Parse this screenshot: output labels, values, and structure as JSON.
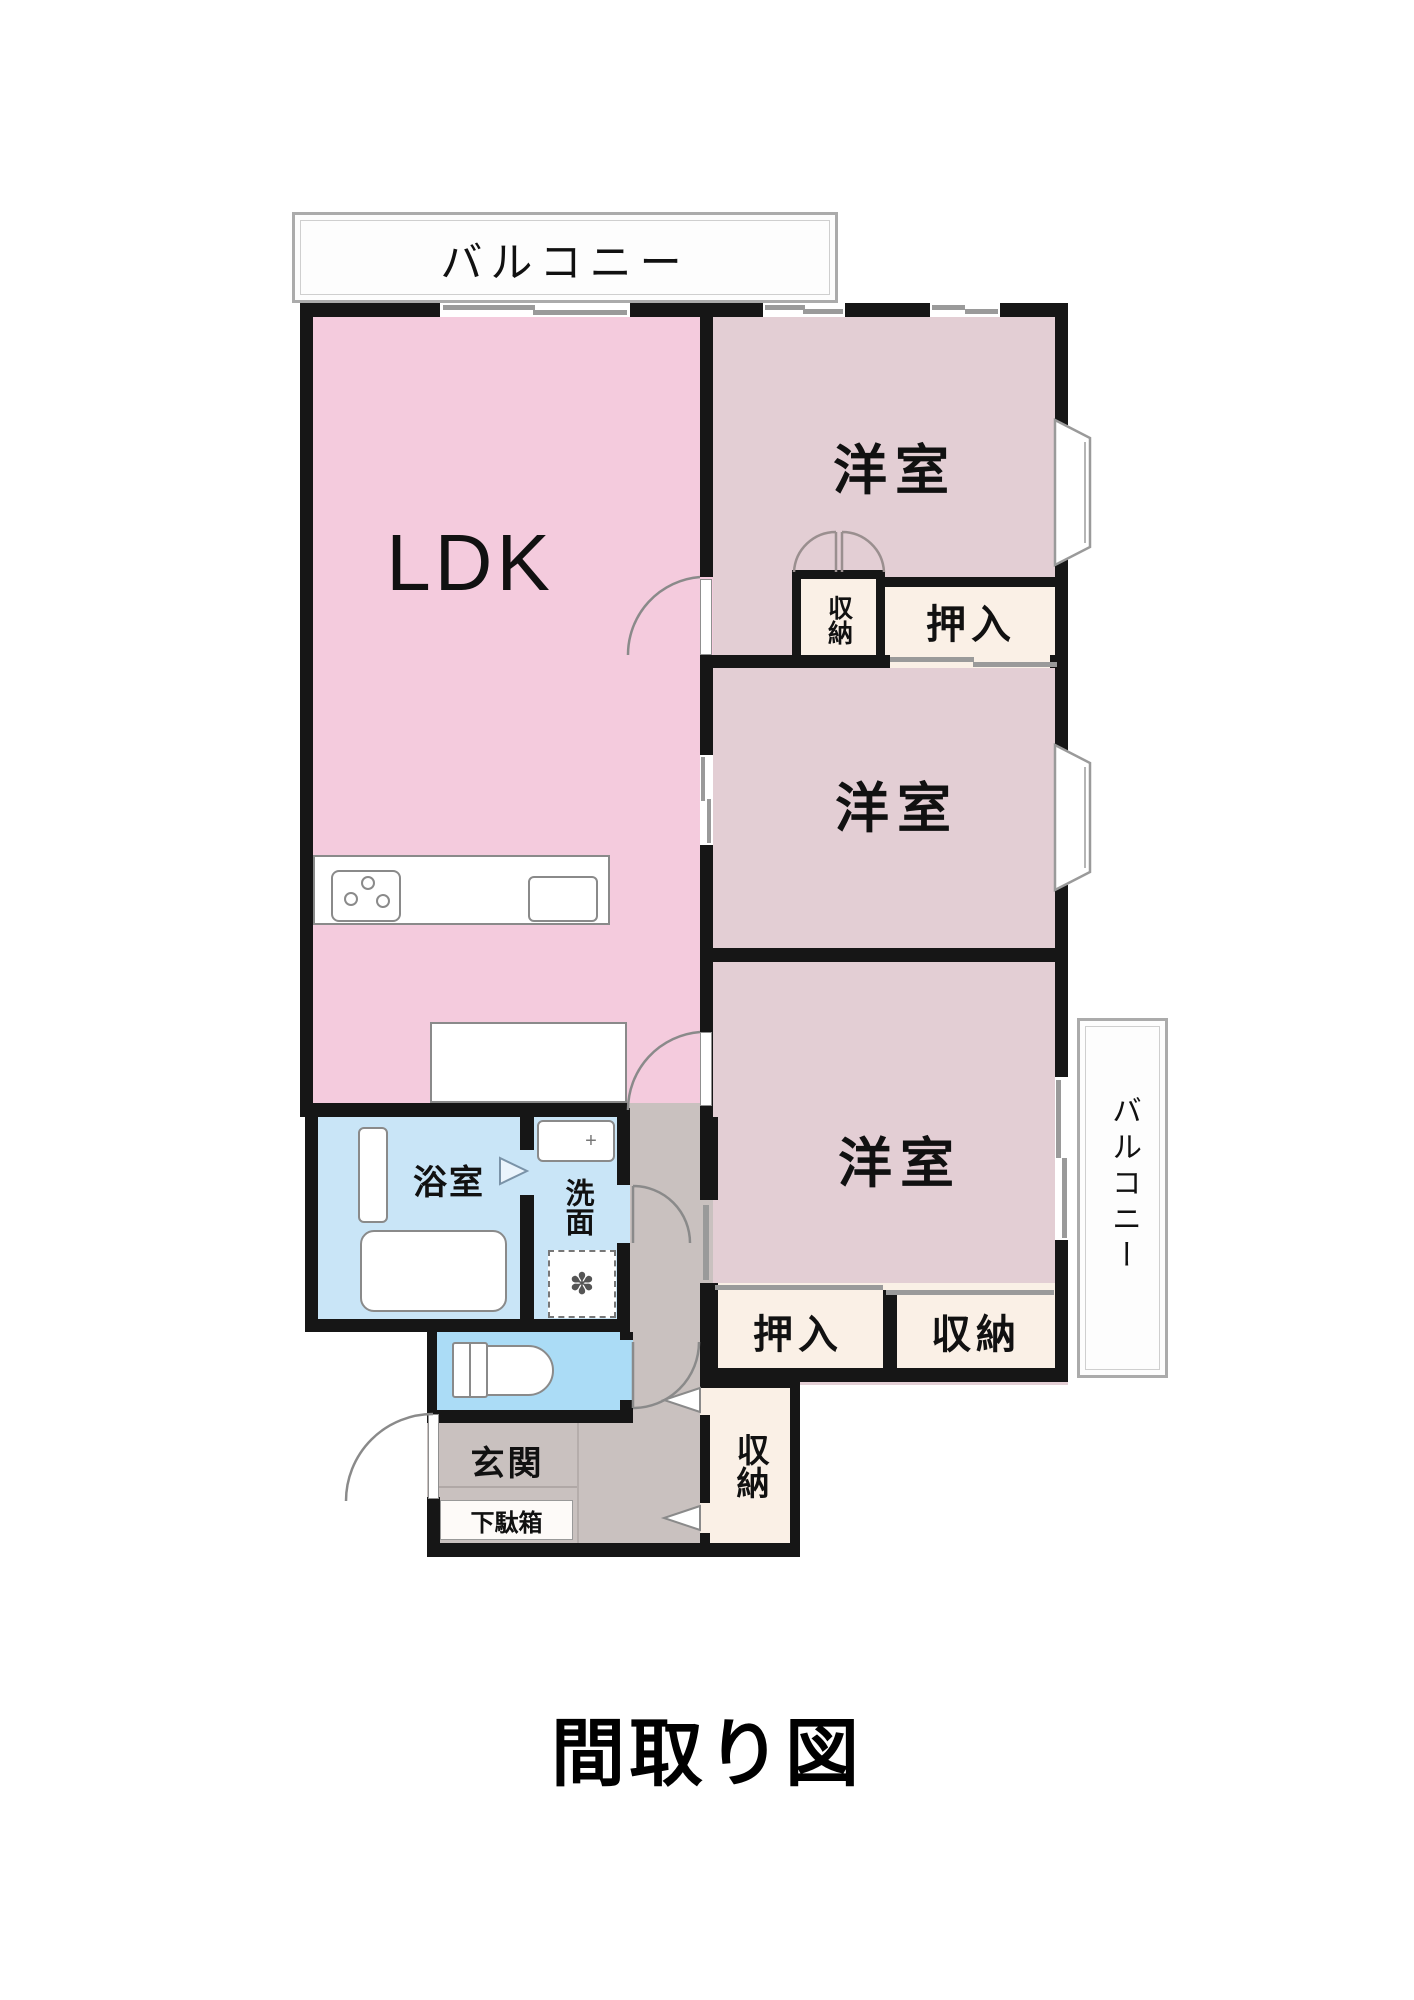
{
  "title": "間取り図",
  "plan": {
    "balconies": {
      "top": "バルコニー",
      "right": "バルコニー"
    },
    "rooms": {
      "ldk": "LDK",
      "bedroom1": "洋室",
      "bedroom2": "洋室",
      "bedroom3": "洋室",
      "bath": "浴室",
      "washroom": "洗面",
      "entrance": "玄関",
      "shoe_cabinet": "下駄箱"
    },
    "storage": {
      "closet1": "収納",
      "oshiire1": "押入",
      "oshiire2": "押入",
      "closet2": "収納",
      "closet3": "収納"
    },
    "icons": {
      "faucet": "+",
      "washer": "✽"
    },
    "colors": {
      "wall": "#161616",
      "ldk": "#f4cbdd",
      "bedroom": "#e3ced4",
      "closet": "#faf0e6",
      "hall": "#c9c1bf",
      "bath": "#c9e5f7",
      "toilet": "#abdcf6",
      "fixture_line": "#8a8a8a",
      "window": "#9a9a9a",
      "balcony_frame": "#ababab",
      "text": "#111111"
    }
  }
}
